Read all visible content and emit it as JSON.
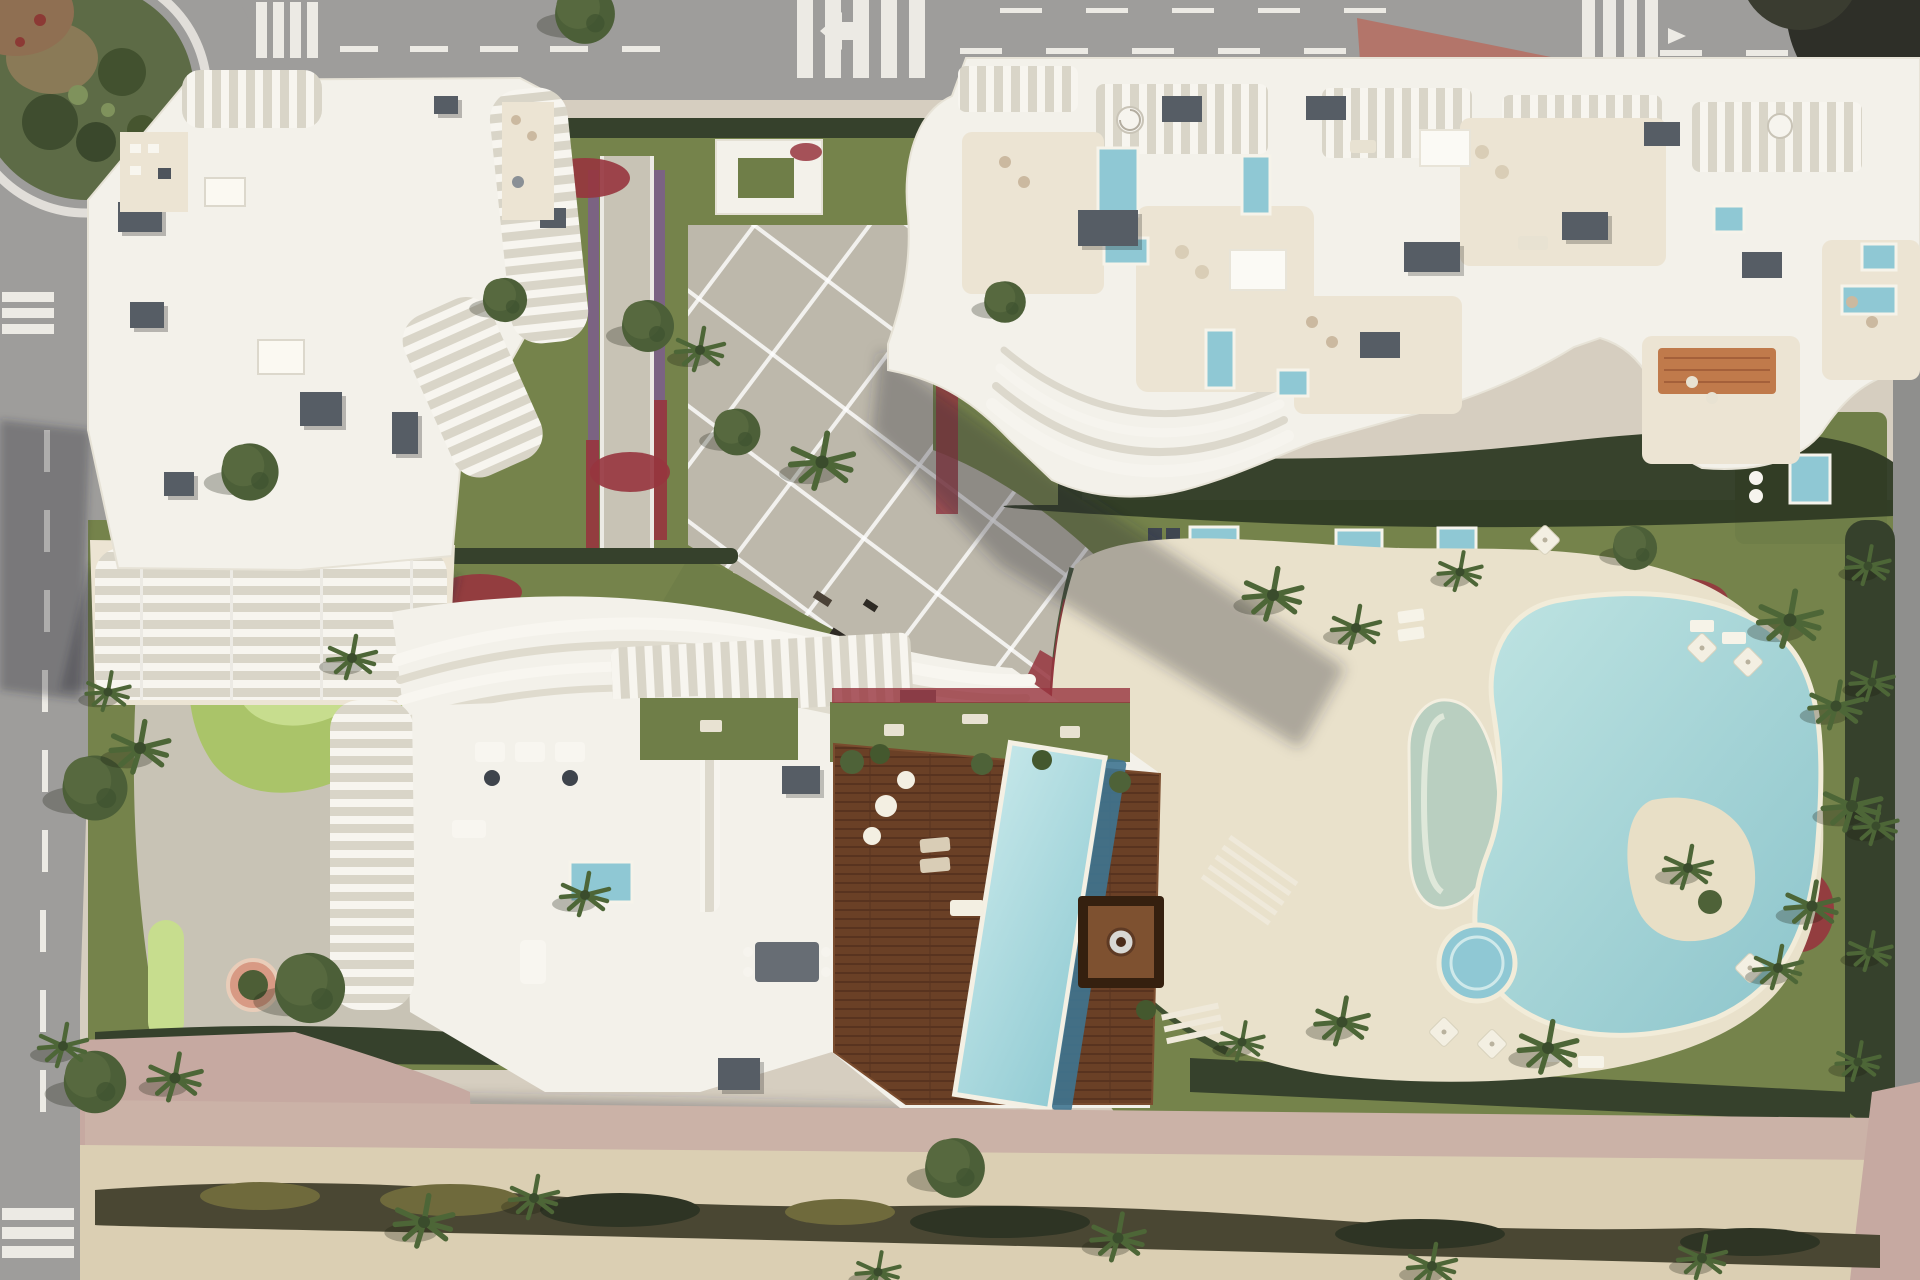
{
  "meta": {
    "title": "Aerial render of seaside residential complex",
    "description": "Top-down 3D architectural rendering: three sculptural white apartment buildings with louvered balconies and roof terraces, communal gardens, mini-golf, a lagoon-style pool complex with lap pool and jacuzzi, surrounded by roads with crosswalks and a sandy promenade with palm trees.",
    "image_type": "photorealistic aerial 3D render",
    "width_px": 1920,
    "height_px": 1280,
    "visible_text": []
  },
  "palette": {
    "sand": "#d6cec0",
    "asphalt": "#9e9d9b",
    "asphalt2": "#8f8f8d",
    "mark": "#eceae4",
    "lawn": "#75834b",
    "lawn2": "#6f7e48",
    "hedge": "#36412c",
    "hedgeDark": "#2e3a24",
    "paver": "#bdb8ab",
    "paver2": "#c8c3b5",
    "buildingWhite": "#f3f1ea",
    "terraceCream": "#ece4d3",
    "slatBase": "#d9d5c8",
    "slatBar": "#f7f5ef",
    "roofBox": "#565d65",
    "plungePool": "#8fc8d4",
    "flowerRed": "#97353e",
    "flowerPurple": "#7c5e8c",
    "trafficIsland": "#b3756a",
    "golfGreen": "#aac469",
    "golfLight": "#c7dd8e",
    "pinkPath": "#cbb2a7",
    "pinkSidewalk": "#c6a9a1",
    "promenade": "#dbcfb3",
    "hedgeBand": "#4a4733",
    "poolDeck": "#e9e1cb",
    "deckWood": "#6a4026",
    "deckWoodDark": "#58331f",
    "pavilion": "#35200f",
    "islandSand": "#e8dfc6",
    "crescentPool": "#b9cfc0",
    "lapPool": "#5f9cb2",
    "lagoonLight": "#bfe4e2",
    "lagoonDeep": "#8cc4cb",
    "rug": "#c07a4b",
    "woodTable": "#bb8d5e",
    "roundabout": "#5d6b46",
    "treeGreen": "#4c5f38",
    "palmGreen": "#4d6637",
    "ringWhite": "#e8e6e0"
  },
  "scene": {
    "roads": {
      "top_road": "wide asphalt avenue across the top with dashed lane lines, three zebra crosswalks, a white left-turn arrow, a white van and a dark car",
      "left_road": "vertical street along the left edge with dashed center line and two zebra crosswalks",
      "right_road": "narrow road sliver along the right edge behind a tall hedge",
      "roundabout": "landscaped roundabout in the top-left corner with palms and cacti on a green island inside a white ring",
      "traffic_islands": [
        "red-brown triangular island below the top road",
        "red-brown island at the top-right junction",
        "pink sidewalk areas at the bottom-left and bottom-right corners"
      ]
    },
    "buildings": [
      {
        "id": "northwest-tower",
        "description": "white tower, top-left, with curved vertical louver balconies, rooftop HVAC boxes and lower slatted terraces"
      },
      {
        "id": "northeast-tower",
        "description": "long white building across the top-right with pergola slat roofs, cream roof terraces, small turquoise plunge pools, an orange rug and wavy stacked balconies at its south-west corner"
      },
      {
        "id": "south-building",
        "description": "bottom-centre building with wavy white roof ribbons, pergola colonnades, white terrace with small pool, large hardwood deck, dark pavilion and a long angled swimming pool"
      }
    ],
    "amenities": {
      "lagoon_pool_complex": "organic lagoon pool with sandy palm island, D-shaped crescent pool, angled lap pool, round jacuzzi and stepped entry on a cream deck",
      "mini_golf": "bright putting greens (kidney shape and lollipop holes) in the south-west garden",
      "gym_lawn": "outdoor exercise equipment on a lawn beside the diagonal promenade",
      "plaza": "diagonal paved plaza with white grid joints connecting the entrance to the pool deck",
      "gardens": "lawns, dark hedges, red bougainvillea and purple flower bands, palm trees, white sun umbrellas and loungers",
      "promenade": "sandy beach promenade along the bottom with a long hedge band and palms"
    }
  }
}
